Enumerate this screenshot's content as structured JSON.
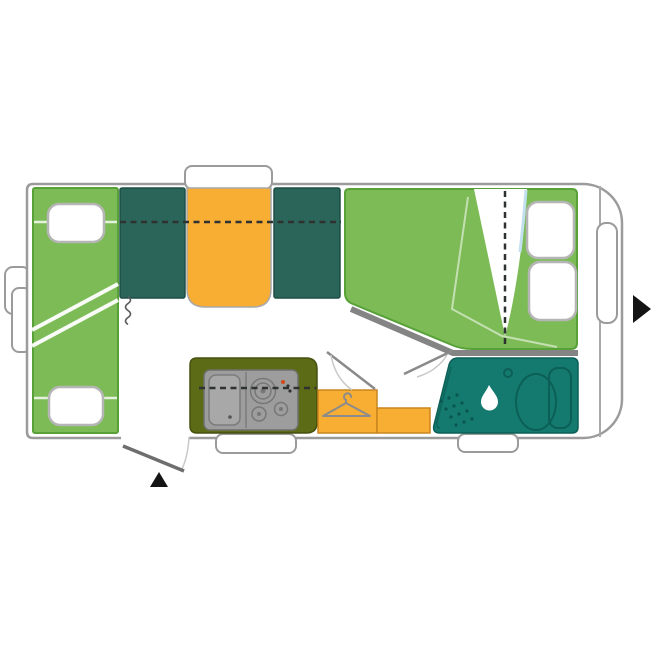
{
  "page": {
    "title": "caravan-floorplan-top-view",
    "background": "#ffffff"
  },
  "colors": {
    "body_outline": "#9b9b9b",
    "upholstery_green": "#7cbb55",
    "upholstery_green_border": "#58a139",
    "cushion_teal": "#2b6459",
    "cushion_teal_border": "#1d4f46",
    "table_orange": "#f8ad33",
    "orange_border": "#c9861f",
    "kitchen_olive": "#5c6b16",
    "kitchen_olive_border": "#45510e",
    "appliance_gray": "#9d9d9d",
    "appliance_dark": "#6f6f6f",
    "bathroom_teal": "#147a6f",
    "bathroom_teal_dark": "#0b5f56",
    "wall_bar_gray": "#848484",
    "door_gray": "#6e6e6e",
    "swing_gray": "#8a8a8a",
    "arc_gray": "#c9c9c9",
    "dash_dark": "#2e3230",
    "pillow_border": "#b5b5b5",
    "arrow_black": "#141414",
    "burner_red": "#d2491b",
    "sheet_blue": "#c3e0f0",
    "hanger_gray": "#8b8b8b"
  },
  "icons": {
    "shower": {
      "name": "water-drop-icon",
      "glyph": "drop-shape"
    },
    "wardrobe": {
      "name": "hanger-icon",
      "glyph": "clothes-hanger-shape"
    },
    "entrance": {
      "name": "entrance-arrow-icon",
      "glyph": "triangle-up"
    },
    "travel_direction": {
      "name": "direction-arrow-icon",
      "glyph": "triangle-right"
    }
  },
  "plan": {
    "areas": [
      {
        "name": "side-sofa-bed",
        "color_key": "upholstery_green"
      },
      {
        "name": "dinette-seats",
        "color_key": "cushion_teal"
      },
      {
        "name": "dinette-table",
        "color_key": "table_orange"
      },
      {
        "name": "french-bed",
        "color_key": "upholstery_green"
      },
      {
        "name": "kitchen-block",
        "color_key": "kitchen_olive"
      },
      {
        "name": "washroom",
        "color_key": "bathroom_teal"
      },
      {
        "name": "wardrobe",
        "color_key": "table_orange"
      }
    ]
  }
}
